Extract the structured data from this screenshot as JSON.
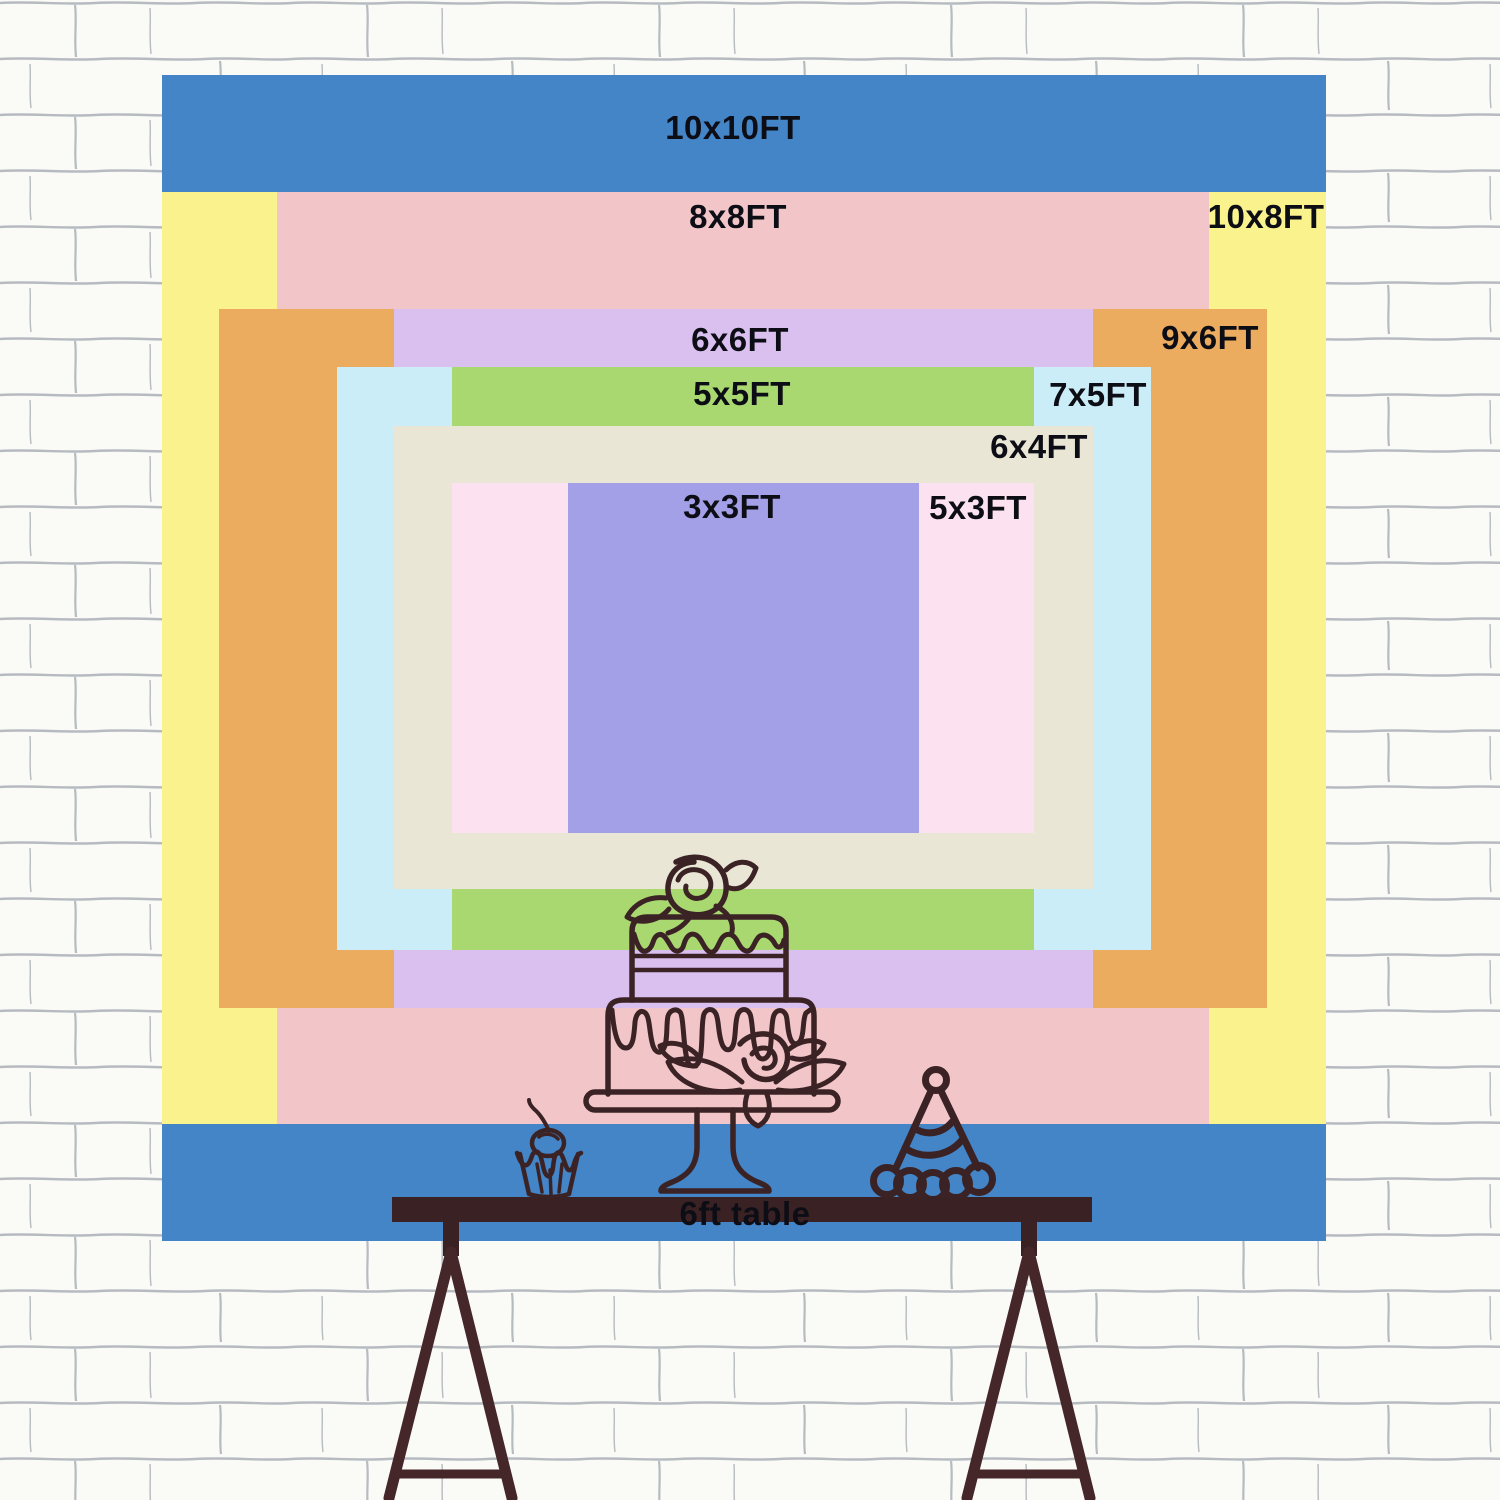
{
  "backdrop": {
    "label_color": "#0D0D15",
    "sizes": [
      {
        "id": "10x10",
        "label": "10x10FT",
        "width_ft": 10,
        "height_ft": 10,
        "color": "#4385C7"
      },
      {
        "id": "10x8",
        "label": "10x8FT",
        "width_ft": 10,
        "height_ft": 8,
        "color": "#FAF28C"
      },
      {
        "id": "8x8",
        "label": "8x8FT",
        "width_ft": 8,
        "height_ft": 8,
        "color": "#F2C6C9"
      },
      {
        "id": "9x6",
        "label": "9x6FT",
        "width_ft": 9,
        "height_ft": 6,
        "color": "#ECAC5F"
      },
      {
        "id": "6x6",
        "label": "6x6FT",
        "width_ft": 6,
        "height_ft": 6,
        "color": "#DAC0EF"
      },
      {
        "id": "7x5",
        "label": "7x5FT",
        "width_ft": 7,
        "height_ft": 5,
        "color": "#CBEDF8"
      },
      {
        "id": "5x5",
        "label": "5x5FT",
        "width_ft": 5,
        "height_ft": 5,
        "color": "#A9D871"
      },
      {
        "id": "6x4",
        "label": "6x4FT",
        "width_ft": 6,
        "height_ft": 4,
        "color": "#EAE6D6"
      },
      {
        "id": "5x3",
        "label": "5x3FT",
        "width_ft": 5,
        "height_ft": 3,
        "color": "#FCE1F0"
      },
      {
        "id": "3x3",
        "label": "3x3FT",
        "width_ft": 3,
        "height_ft": 3,
        "color": "#A3A0E8"
      }
    ]
  },
  "table": {
    "label": "6ft table",
    "color": "#3A2224",
    "leg_color": "#452629"
  },
  "doodles": {
    "stroke": "#3B2325",
    "items": [
      "tiered-cake-icon",
      "cupcake-icon",
      "party-hat-icon"
    ]
  },
  "wall": {
    "background": "#FAFAF7",
    "mortar": "#7E8694"
  }
}
